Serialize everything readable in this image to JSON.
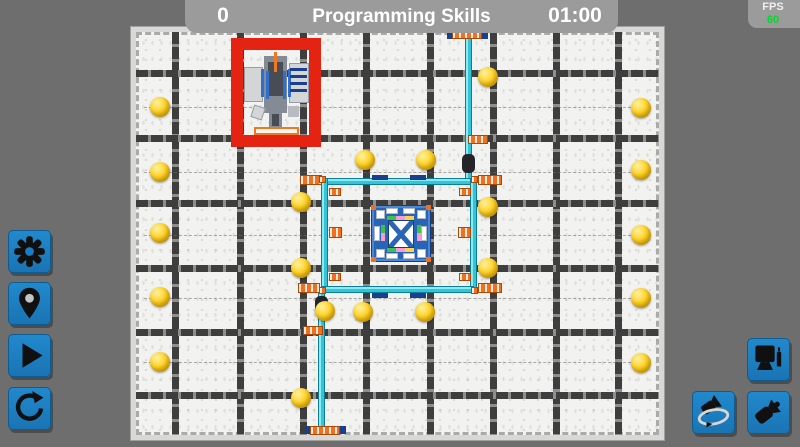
{
  "colors": {
    "bg": "#6e6e6e",
    "bar_bg": "#9b9b9b",
    "text_white": "#ffffff",
    "fps_green": "#00dc28",
    "btn_blue": "#1b7ec4",
    "btn_blue_dark": "#0f5c92",
    "field_plate": "#d8d8d6",
    "field_white": "#f2f2f0",
    "grid_dark": "#3e3e3e",
    "grid_gap": "#8e8e8c",
    "ball_hi": "#fff0a0",
    "ball_mid": "#ffd428",
    "ball_dark": "#cfa400",
    "pipe_hi": "#8ceaf2",
    "pipe_mid": "#35c3d8",
    "pipe_dark": "#1495ac",
    "pipe_edge": "#0c7e96",
    "navy": "#1b3f8f",
    "conn_orange": "#f07020",
    "sleeve_black": "#24242a",
    "red_box": "#e42313",
    "platform_blue": "#2a64b4",
    "platform_edge": "#173f7e",
    "strip_green": "#3fc04c",
    "strip_pink": "#f79cd0",
    "strip_yellow": "#ffd24a",
    "robot_light": "#d4d5d7",
    "robot_mid": "#858b95",
    "robot_dark": "#474c55",
    "robot_blue": "#2f6fd0",
    "robot_orange": "#f07820"
  },
  "top_bar": {
    "score": "0",
    "title": "Programming Skills",
    "timer": "01:00"
  },
  "fps_panel": {
    "label": "FPS",
    "value": "60"
  },
  "left_toolbar": {
    "buttons": [
      "settings",
      "set-position",
      "play",
      "reset"
    ]
  },
  "right_toolbar": {
    "buttons": [
      "screen",
      "orbit-camera",
      "camera"
    ]
  },
  "field": {
    "inner": {
      "x": 136,
      "y": 32,
      "w": 523,
      "h": 403
    },
    "grid": {
      "v": [
        175,
        240,
        303,
        366,
        430,
        493,
        556,
        618
      ],
      "h": [
        73,
        138,
        203,
        268,
        332,
        395
      ],
      "center_h": [
        107,
        172,
        235,
        298,
        362
      ]
    },
    "balls": [
      [
        160,
        107
      ],
      [
        160,
        172
      ],
      [
        160,
        233
      ],
      [
        160,
        297
      ],
      [
        160,
        362
      ],
      [
        641,
        108
      ],
      [
        641,
        170
      ],
      [
        641,
        235
      ],
      [
        641,
        298
      ],
      [
        641,
        363
      ],
      [
        488,
        77
      ],
      [
        365,
        160
      ],
      [
        426,
        160
      ],
      [
        301,
        202
      ],
      [
        488,
        207
      ],
      [
        301,
        268
      ],
      [
        488,
        268
      ],
      [
        325,
        311
      ],
      [
        363,
        312
      ],
      [
        425,
        312
      ],
      [
        301,
        398
      ]
    ],
    "pipes": [
      {
        "x": 465,
        "y": 34,
        "w": 7,
        "h": 147,
        "o": "v"
      },
      {
        "x": 322,
        "y": 178,
        "w": 152,
        "h": 7,
        "o": "h"
      },
      {
        "x": 321,
        "y": 178,
        "w": 7,
        "h": 114,
        "o": "v"
      },
      {
        "x": 470,
        "y": 178,
        "w": 7,
        "h": 114,
        "o": "v"
      },
      {
        "x": 322,
        "y": 286,
        "w": 152,
        "h": 7,
        "o": "h"
      },
      {
        "x": 318,
        "y": 291,
        "w": 7,
        "h": 141,
        "o": "v"
      }
    ],
    "navy_marks": [
      [
        372,
        175,
        16,
        5
      ],
      [
        410,
        175,
        16,
        5
      ],
      [
        372,
        293,
        16,
        5
      ],
      [
        410,
        293,
        16,
        5
      ],
      [
        447,
        31,
        8,
        8
      ],
      [
        480,
        31,
        8,
        8
      ],
      [
        305,
        426,
        8,
        8
      ],
      [
        338,
        426,
        8,
        8
      ]
    ],
    "connectors": [
      [
        452,
        30,
        30,
        9
      ],
      [
        468,
        135,
        20,
        9
      ],
      [
        300,
        175,
        22,
        10
      ],
      [
        478,
        175,
        24,
        10
      ],
      [
        319,
        176,
        7,
        7
      ],
      [
        471,
        176,
        7,
        7
      ],
      [
        319,
        287,
        7,
        7
      ],
      [
        471,
        287,
        7,
        7
      ],
      [
        329,
        188,
        12,
        8
      ],
      [
        459,
        188,
        12,
        8
      ],
      [
        329,
        227,
        13,
        11
      ],
      [
        458,
        227,
        13,
        11
      ],
      [
        298,
        283,
        22,
        10
      ],
      [
        478,
        283,
        24,
        10
      ],
      [
        329,
        273,
        12,
        8
      ],
      [
        459,
        273,
        12,
        8
      ],
      [
        303,
        326,
        20,
        9
      ],
      [
        310,
        426,
        30,
        9
      ]
    ],
    "sleeves": [
      [
        462,
        154,
        13,
        19
      ],
      [
        315,
        296,
        13,
        19
      ]
    ]
  }
}
